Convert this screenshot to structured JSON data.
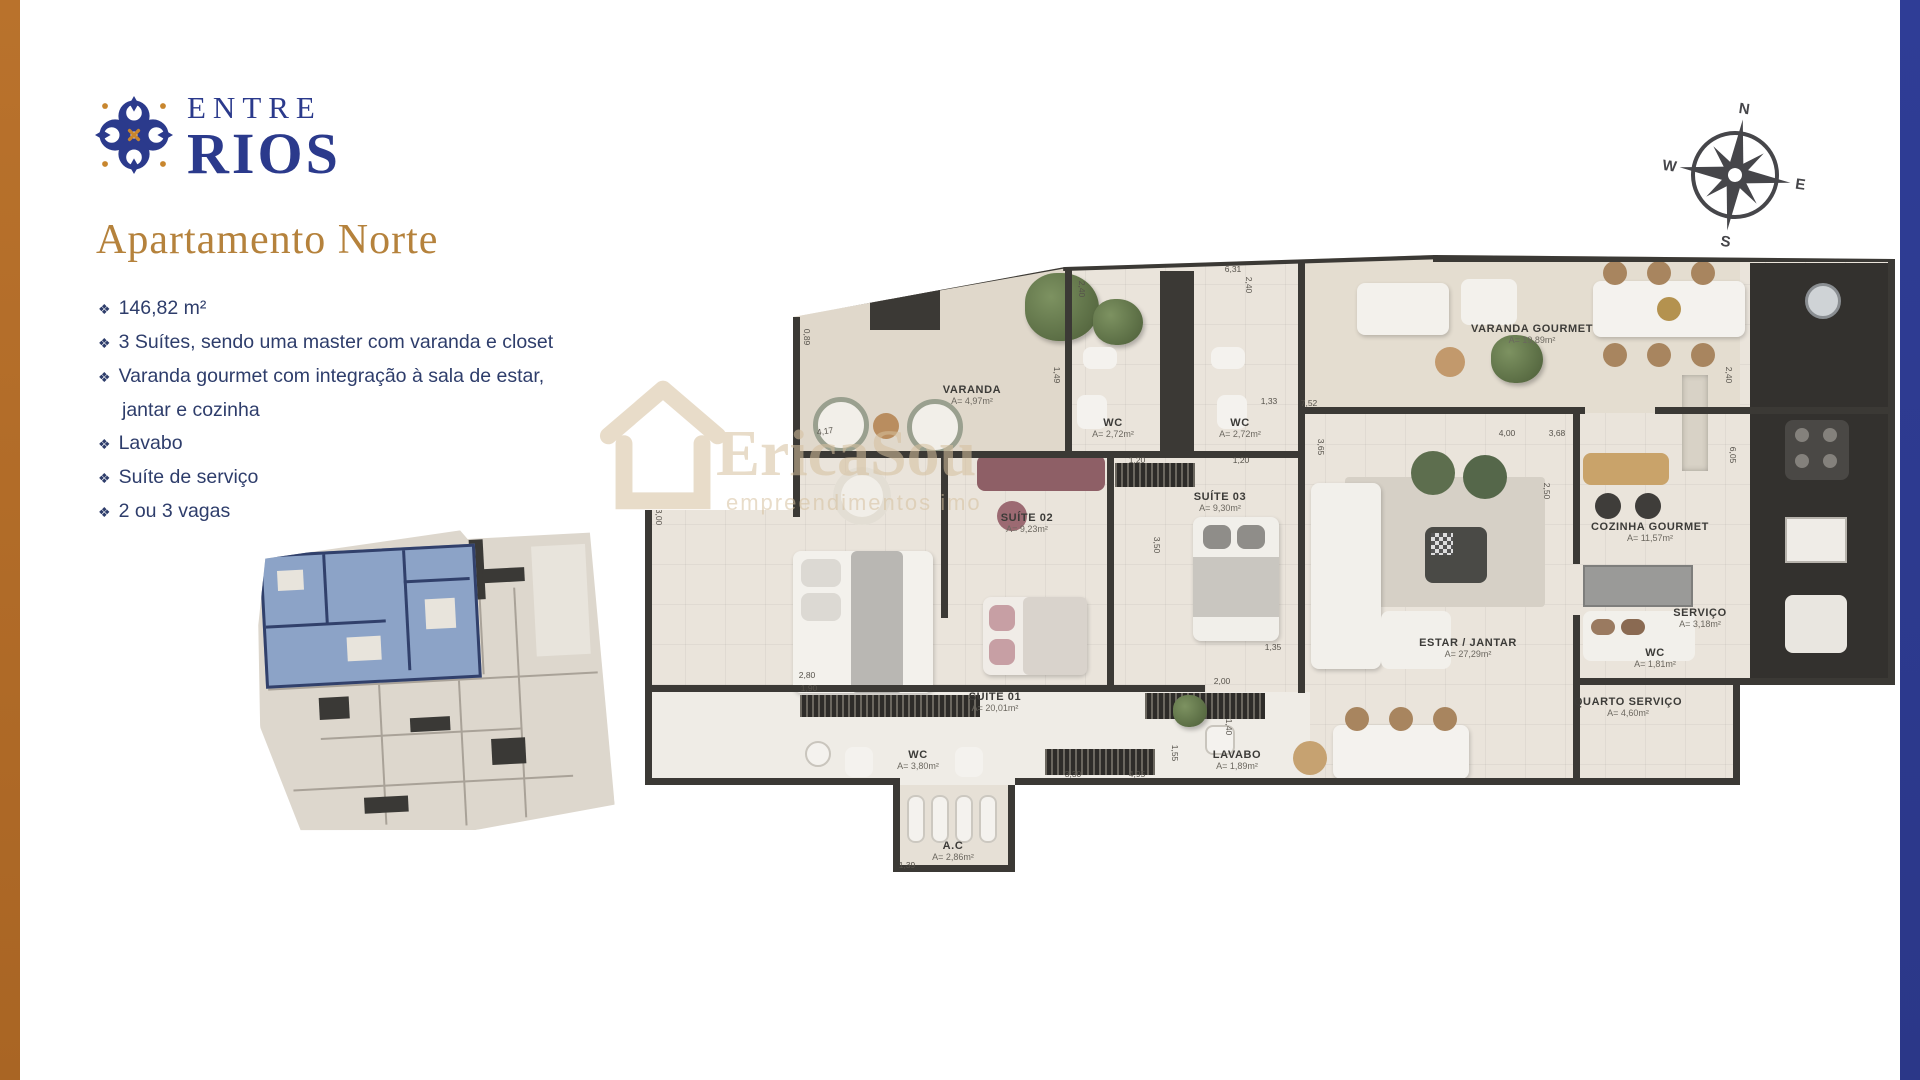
{
  "branding": {
    "logo_line1": "ENTRE",
    "logo_line2": "RIOS"
  },
  "page": {
    "title": "Apartamento Norte"
  },
  "features": [
    "146,82 m²",
    "3 Suítes, sendo uma master com varanda e closet",
    "Varanda gourmet com integração à sala de estar, jantar e cozinha",
    "Lavabo",
    "Suíte de serviço",
    "2 ou 3 vagas"
  ],
  "compass": {
    "north": "N",
    "south": "S",
    "east": "E",
    "west": "W"
  },
  "watermark": {
    "name": "EricaSou",
    "tagline": "empreendimentos imo"
  },
  "floor_plan": {
    "rooms": [
      {
        "name": "VARANDA",
        "area": "A= 4,97m²",
        "x": 327,
        "y": 140
      },
      {
        "name": "WC",
        "area": "A= 2,72m²",
        "x": 468,
        "y": 173
      },
      {
        "name": "WC",
        "area": "A= 2,72m²",
        "x": 595,
        "y": 173
      },
      {
        "name": "SUÍTE 02",
        "area": "A= 9,23m²",
        "x": 382,
        "y": 268
      },
      {
        "name": "SUÍTE 03",
        "area": "A= 9,30m²",
        "x": 575,
        "y": 247
      },
      {
        "name": "SUÍTE 01",
        "area": "A= 20,01m²",
        "x": 350,
        "y": 447
      },
      {
        "name": "WC",
        "area": "A= 3,80m²",
        "x": 273,
        "y": 505
      },
      {
        "name": "LAVABO",
        "area": "A= 1,89m²",
        "x": 592,
        "y": 505
      },
      {
        "name": "ESTAR / JANTAR",
        "area": "A= 27,29m²",
        "x": 823,
        "y": 393
      },
      {
        "name": "VARANDA GOURMET",
        "area": "A= 19,89m²",
        "x": 887,
        "y": 79
      },
      {
        "name": "COZINHA GOURMET",
        "area": "A= 11,57m²",
        "x": 1005,
        "y": 277
      },
      {
        "name": "QUARTO SERVIÇO",
        "area": "A= 4,60m²",
        "x": 983,
        "y": 452
      },
      {
        "name": "SERVIÇO",
        "area": "A= 3,18m²",
        "x": 1055,
        "y": 363
      },
      {
        "name": "WC",
        "area": "A= 1,81m²",
        "x": 1010,
        "y": 403
      },
      {
        "name": "A.C",
        "area": "A= 2,86m²",
        "x": 308,
        "y": 596
      }
    ],
    "dimensions": [
      {
        "text": "0,89",
        "x": 162,
        "y": 82,
        "rot": 90
      },
      {
        "text": "4,17",
        "x": 180,
        "y": 176,
        "rot": -8
      },
      {
        "text": "3,00",
        "x": 14,
        "y": 262,
        "rot": 90
      },
      {
        "text": "2,40",
        "x": 437,
        "y": 34,
        "rot": 90
      },
      {
        "text": "2,40",
        "x": 604,
        "y": 30,
        "rot": 90
      },
      {
        "text": "1,49",
        "x": 412,
        "y": 120,
        "rot": 90
      },
      {
        "text": "1,20",
        "x": 492,
        "y": 205,
        "rot": 0
      },
      {
        "text": "1,20",
        "x": 596,
        "y": 205,
        "rot": 0
      },
      {
        "text": "3,50",
        "x": 512,
        "y": 290,
        "rot": 90
      },
      {
        "text": "2,80",
        "x": 162,
        "y": 420,
        "rot": 0
      },
      {
        "text": "1,90",
        "x": 164,
        "y": 433,
        "rot": 0
      },
      {
        "text": "6,31",
        "x": 588,
        "y": 14,
        "rot": 0
      },
      {
        "text": "1,33",
        "x": 624,
        "y": 146,
        "rot": 0
      },
      {
        "text": "7,52",
        "x": 664,
        "y": 148,
        "rot": 0
      },
      {
        "text": "3,65",
        "x": 676,
        "y": 192,
        "rot": 90
      },
      {
        "text": "4,00",
        "x": 862,
        "y": 178,
        "rot": 0
      },
      {
        "text": "3,68",
        "x": 912,
        "y": 178,
        "rot": 0
      },
      {
        "text": "2,50",
        "x": 902,
        "y": 236,
        "rot": 90
      },
      {
        "text": "2,40",
        "x": 1084,
        "y": 120,
        "rot": 90
      },
      {
        "text": "6,05",
        "x": 1088,
        "y": 200,
        "rot": 90
      },
      {
        "text": "2,00",
        "x": 577,
        "y": 426,
        "rot": 0
      },
      {
        "text": "1,35",
        "x": 628,
        "y": 392,
        "rot": 0
      },
      {
        "text": "1,40",
        "x": 584,
        "y": 472,
        "rot": 90
      },
      {
        "text": "3,30",
        "x": 428,
        "y": 519,
        "rot": 0
      },
      {
        "text": "4,95",
        "x": 492,
        "y": 519,
        "rot": 0
      },
      {
        "text": "1,55",
        "x": 530,
        "y": 498,
        "rot": 90
      },
      {
        "text": "1,98",
        "x": 378,
        "y": 592,
        "rot": 90
      },
      {
        "text": "1,39",
        "x": 262,
        "y": 610,
        "rot": 0
      }
    ]
  },
  "colors": {
    "accent_gold": "#b5823c",
    "brand_navy": "#2b3a8c",
    "text_navy": "#2e3d6b",
    "left_bar": "#b9722c",
    "right_bar": "#2f3d96",
    "wall": "#3b3935",
    "floor": "#eae4db",
    "keyplan_highlight": "#8ca3c7"
  }
}
